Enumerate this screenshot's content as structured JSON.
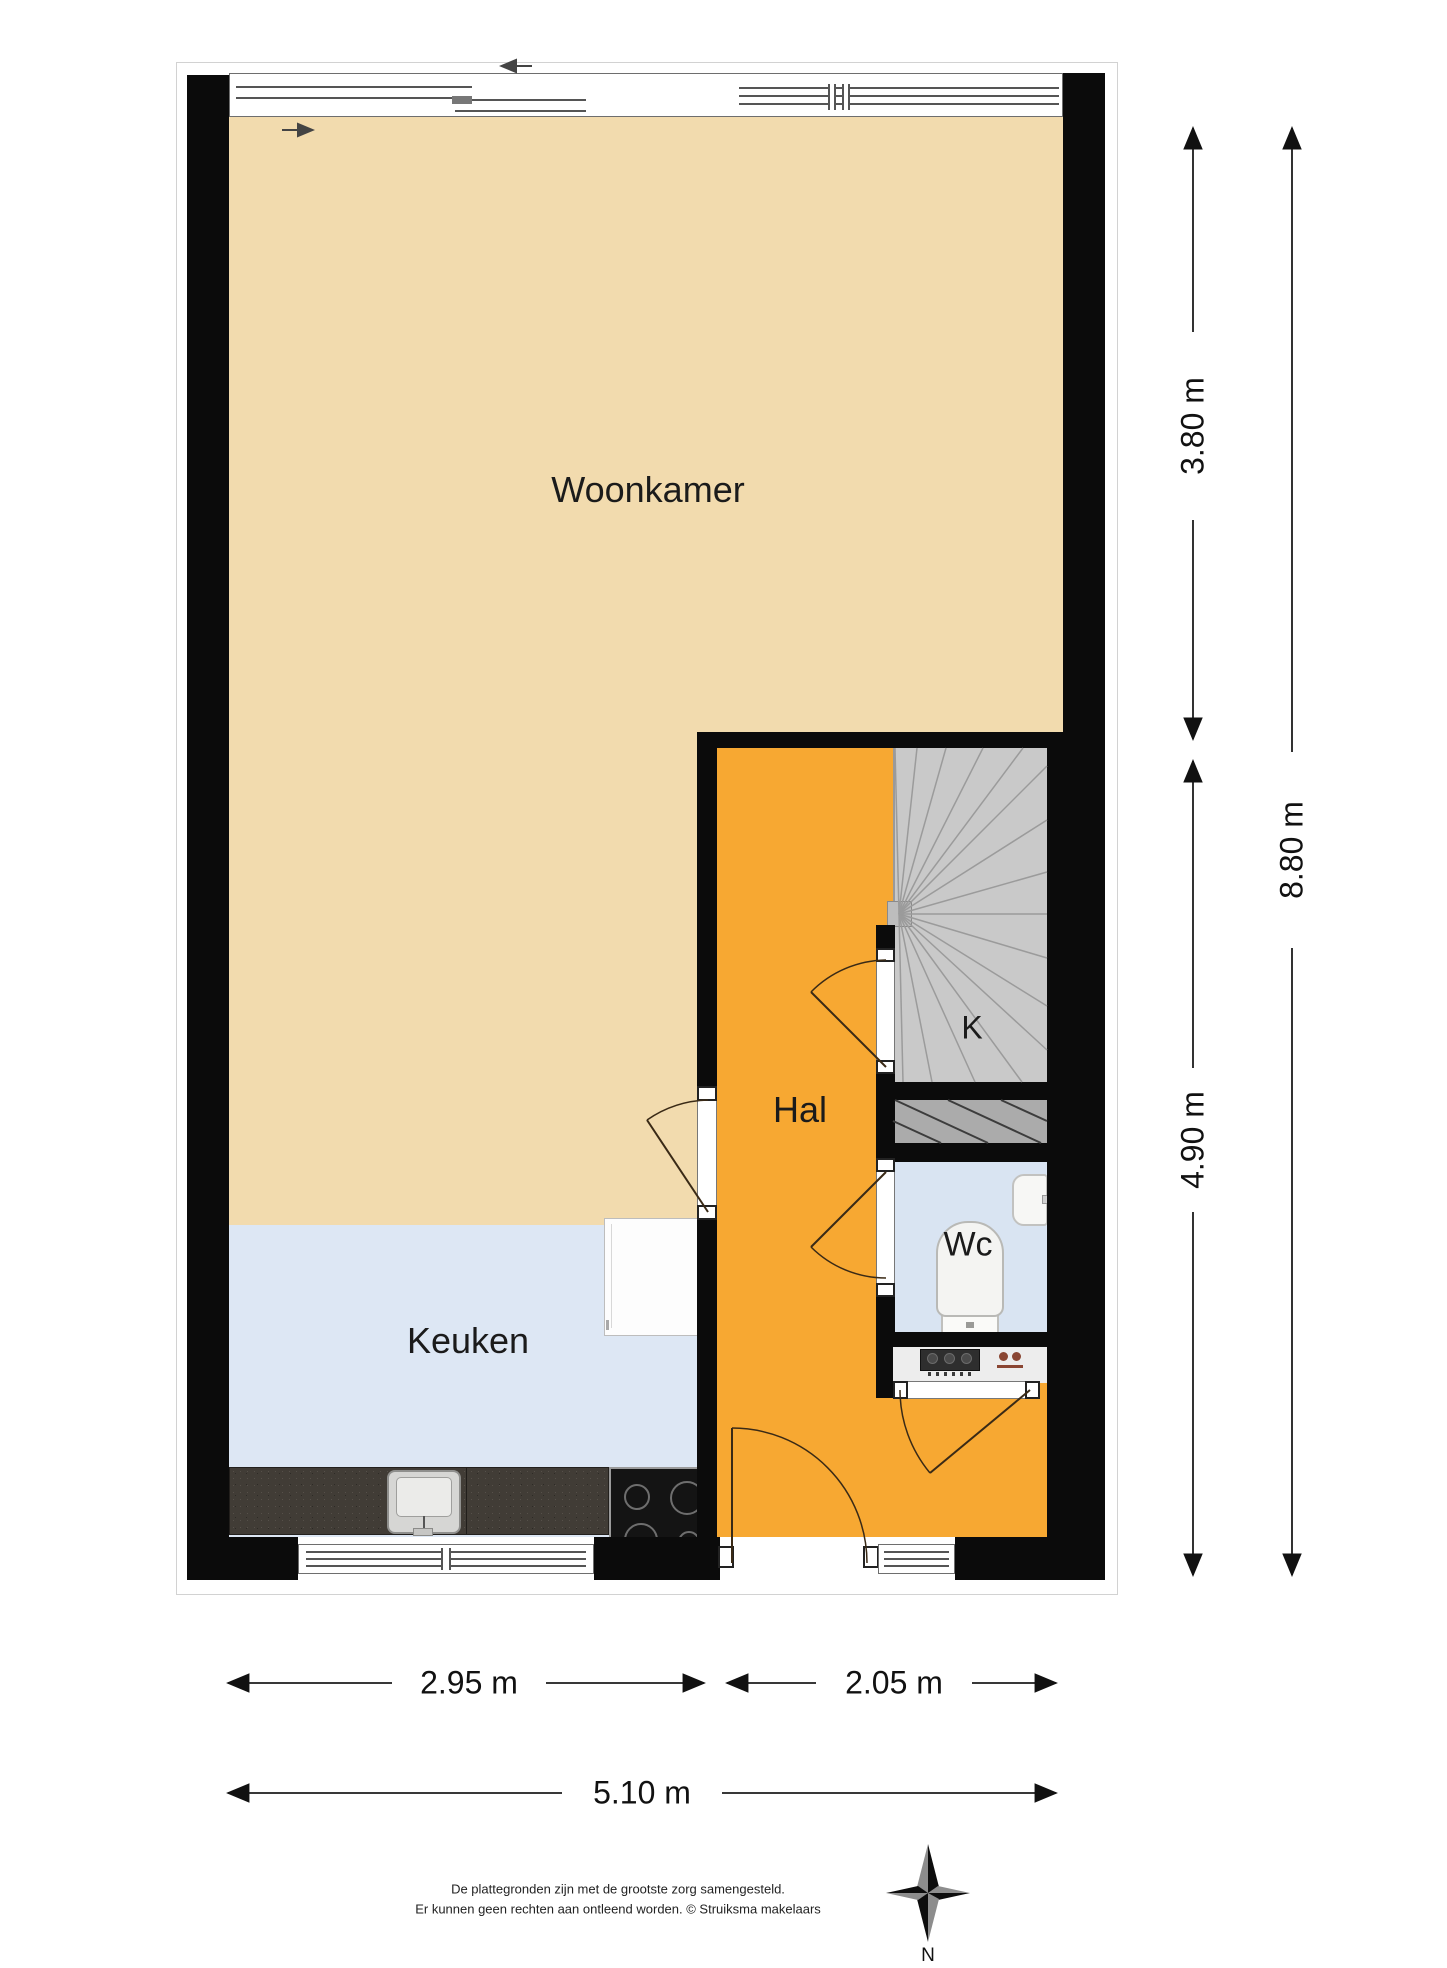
{
  "rooms": {
    "woonkamer": "Woonkamer",
    "keuken": "Keuken",
    "hal": "Hal",
    "kast": "K",
    "wc": "Wc"
  },
  "dimensions": {
    "height_top": "3.80 m",
    "height_total": "8.80 m",
    "height_bottom": "4.90 m",
    "width_left": "2.95 m",
    "width_right": "2.05 m",
    "width_total": "5.10 m"
  },
  "compass": {
    "north": "N"
  },
  "footer": {
    "line1": "De plattegronden zijn met de grootste zorg samengesteld.",
    "line2": "Er kunnen geen rechten aan ontleend worden. © Struiksma makelaars"
  },
  "colors": {
    "wall": "#0b0b0b",
    "woonkamer_floor": "#f2dbae",
    "keuken_floor": "#dde7f4",
    "hal_floor": "#f7a832",
    "stairs_floor": "#c9c9c9",
    "wc_floor": "#d9e4f2",
    "counter": "#413c36"
  }
}
